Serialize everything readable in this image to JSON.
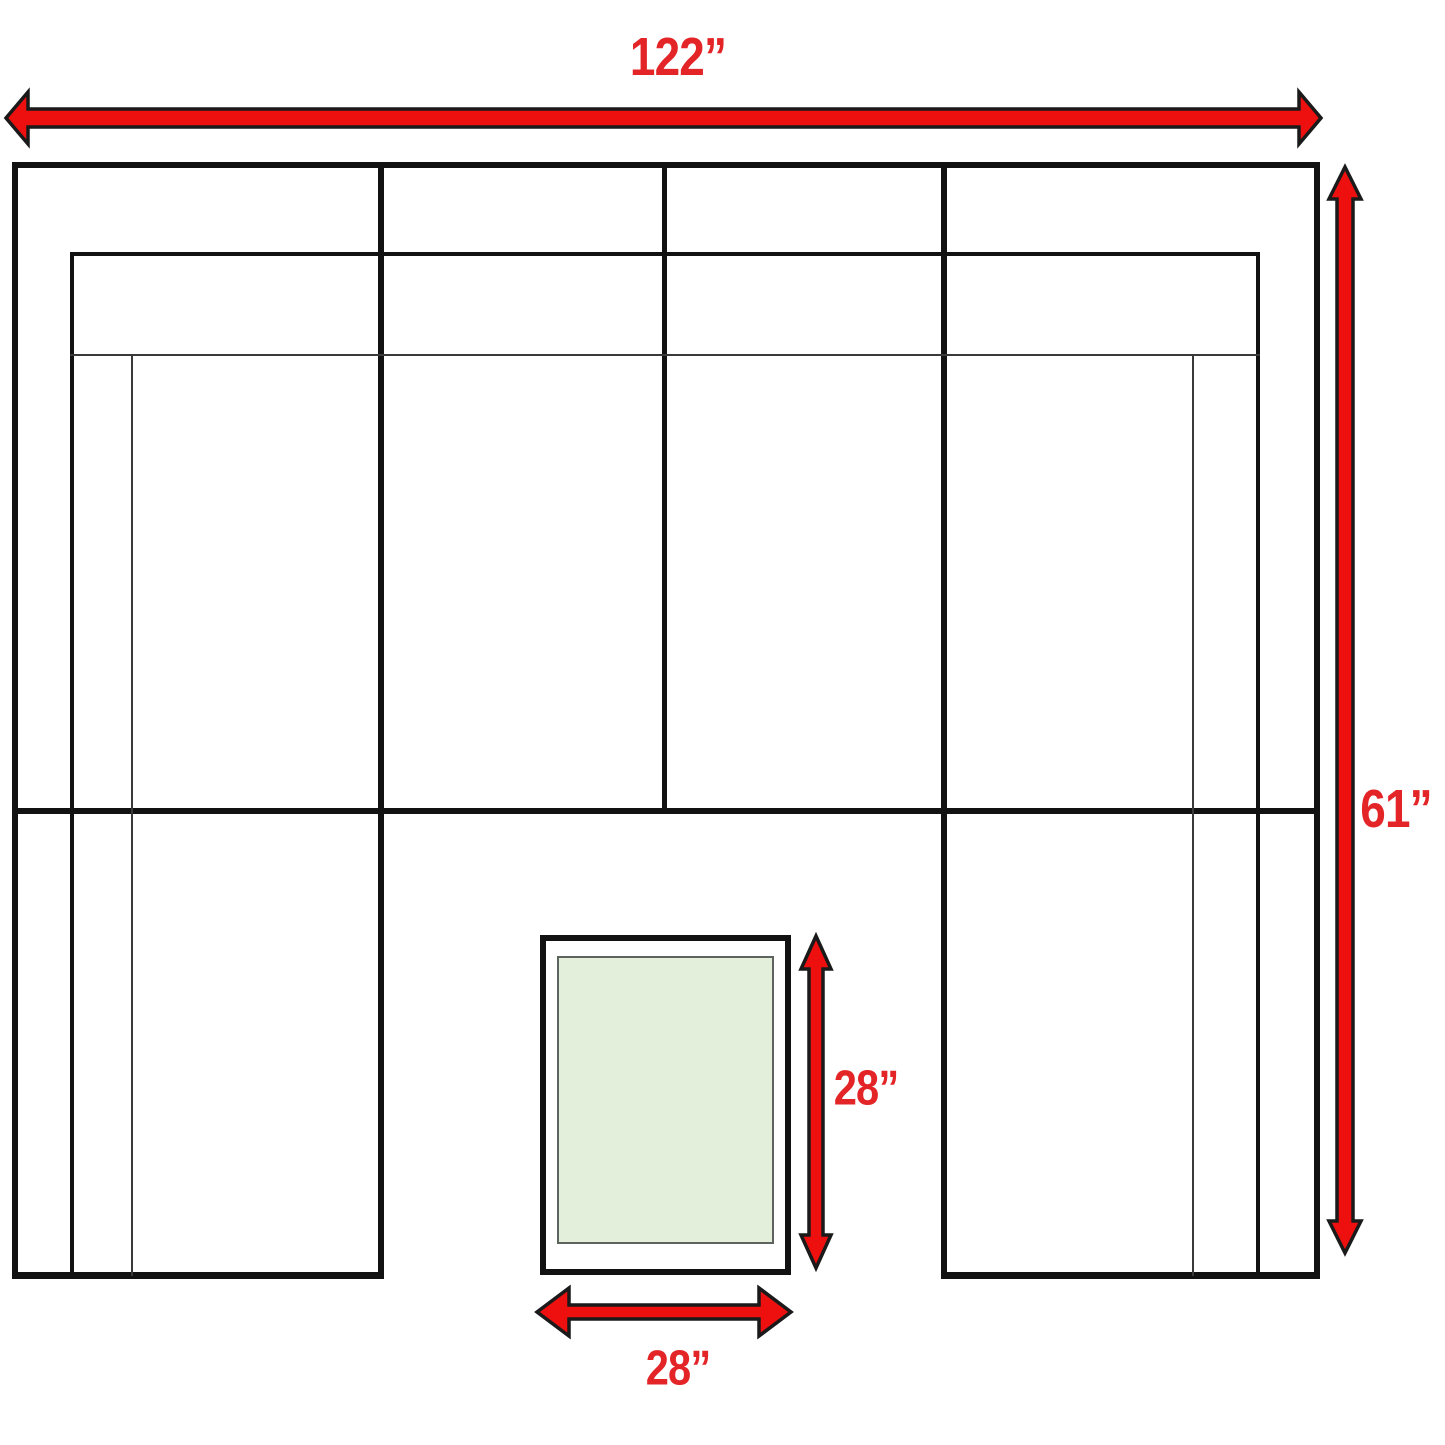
{
  "meta": {
    "title": "Sectional sofa with ottoman — dimension plan"
  },
  "colors": {
    "background": "#ffffff",
    "line": "#121212",
    "line_thin": "#3a3a3a",
    "arrow_fill": "#ee0f0f",
    "arrow_stroke": "#1a1a1a",
    "label": "#e32528",
    "ottoman_fill": "#e3efda",
    "ottoman_border": "#5f6360",
    "ottoman_gap": "#ffffff"
  },
  "labels": {
    "sofa_width": {
      "text": "122”",
      "value": 122,
      "unit": "inches"
    },
    "sofa_depth": {
      "text": "61”",
      "value": 61,
      "unit": "inches"
    },
    "ottoman_depth": {
      "text": "28”",
      "value": 28,
      "unit": "inches"
    },
    "ottoman_width": {
      "text": "28”",
      "value": 28,
      "unit": "inches"
    }
  },
  "shapes": {
    "lines": [
      {
        "name": "sofa-outer-top-edge",
        "x": 12,
        "y": 162,
        "w": 1308,
        "h": 6
      },
      {
        "name": "sofa-outer-left-edge",
        "x": 12,
        "y": 162,
        "w": 6,
        "h": 1117
      },
      {
        "name": "sofa-outer-right-edge",
        "x": 1314,
        "y": 162,
        "w": 6,
        "h": 1117
      },
      {
        "name": "sofa-seat-front-line",
        "x": 12,
        "y": 808,
        "w": 1308,
        "h": 6
      },
      {
        "name": "sofa-left-arm-bottom-edge",
        "x": 12,
        "y": 1272,
        "w": 372,
        "h": 7
      },
      {
        "name": "sofa-right-arm-bottom-edge",
        "x": 941,
        "y": 1272,
        "w": 379,
        "h": 7
      },
      {
        "name": "sofa-divider-left",
        "x": 378,
        "y": 162,
        "w": 6,
        "h": 1117
      },
      {
        "name": "sofa-divider-center",
        "x": 662,
        "y": 162,
        "w": 5,
        "h": 652
      },
      {
        "name": "sofa-divider-right",
        "x": 941,
        "y": 162,
        "w": 6,
        "h": 1117
      },
      {
        "name": "backrest-front-top-line",
        "x": 70,
        "y": 252,
        "w": 1190,
        "h": 4
      },
      {
        "name": "backrest-front-left-line",
        "x": 70,
        "y": 252,
        "w": 4,
        "h": 1024
      },
      {
        "name": "backrest-front-right-line",
        "x": 1256,
        "y": 252,
        "w": 4,
        "h": 1024
      },
      {
        "name": "seat-cushion-line",
        "x": 70,
        "y": 354,
        "w": 1190,
        "h": 2,
        "thin": true
      },
      {
        "name": "left-arm-inner-line",
        "x": 131,
        "y": 354,
        "w": 2,
        "h": 922,
        "thin": true
      },
      {
        "name": "right-arm-inner-line",
        "x": 1192,
        "y": 354,
        "w": 2,
        "h": 922,
        "thin": true
      }
    ],
    "rects": [
      {
        "name": "ottoman-outline",
        "x": 543,
        "y": 938,
        "w": 245,
        "h": 334,
        "kind": "outer"
      },
      {
        "name": "ottoman-top-surface",
        "x": 558,
        "y": 957,
        "w": 215,
        "h": 286,
        "kind": "inner"
      }
    ],
    "arrows": [
      {
        "name": "sofa-width-arrow",
        "dir": "h",
        "x1": 6,
        "x2": 1321,
        "y": 118,
        "sh": 9,
        "hh": 26,
        "hl": 22
      },
      {
        "name": "sofa-depth-arrow",
        "dir": "v",
        "x": 1345,
        "y1": 167,
        "y2": 1253,
        "sh": 8,
        "hh": 16,
        "hl": 32
      },
      {
        "name": "ottoman-depth-arrow",
        "dir": "v",
        "x": 816,
        "y1": 936,
        "y2": 1268,
        "sh": 7,
        "hh": 15,
        "hl": 33
      },
      {
        "name": "ottoman-width-arrow",
        "dir": "h",
        "x1": 537,
        "x2": 791,
        "y": 1312,
        "sh": 7,
        "hh": 24,
        "hl": 32
      }
    ]
  }
}
